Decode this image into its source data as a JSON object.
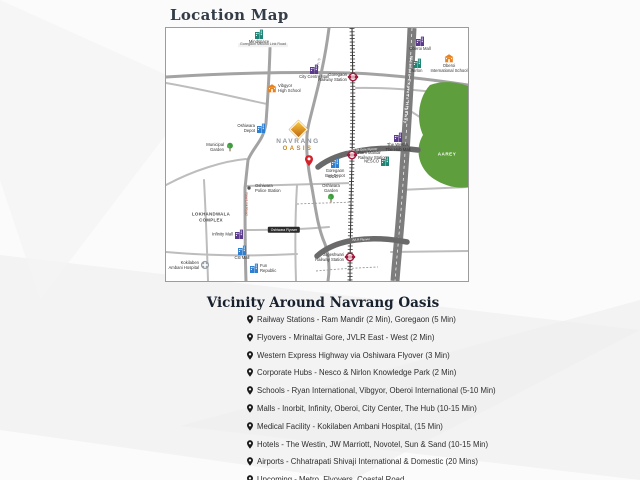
{
  "page": {
    "title": "Location Map"
  },
  "colors": {
    "accent_gold": "#c8861c",
    "station_red": "#9e1b3c",
    "aarey_green": "#5f9e3c",
    "highway_gray": "#7d7d7d"
  },
  "map": {
    "project": {
      "name_line1": "NAVRANG",
      "name_line2": "OASIS"
    },
    "road_labels": [
      {
        "id": "gmlr-road-label",
        "text": "Goregaon Mulund Link Road",
        "x": 97,
        "y": 17,
        "rot": 0,
        "size": 3.6,
        "color": "#555",
        "bg": "#f2f2f2"
      },
      {
        "id": "weh-road-label",
        "text": "Western Express Highway",
        "x": 242,
        "y": 62,
        "rot": 95,
        "size": 4,
        "color": "#ffffff",
        "bold": true,
        "ls": 0.8
      },
      {
        "id": "sv-road-label",
        "text": "S. V. Road",
        "x": 151,
        "y": 38,
        "rot": 100,
        "size": 3.4,
        "color": "#777"
      },
      {
        "id": "new-link-road-label",
        "text": "New Link Road",
        "x": 80,
        "y": 176,
        "rot": 90,
        "size": 3.4,
        "color": "#b5483a"
      },
      {
        "id": "mrinal-tai-gore-flyover-label",
        "text": "Mrinal Tai Gore Flyover",
        "x": 196,
        "y": 122,
        "rot": -3,
        "size": 3,
        "color": "#ffffff"
      },
      {
        "id": "jvlr-flyover-label",
        "text": "JVLR Flyover",
        "x": 195,
        "y": 212,
        "rot": -3,
        "size": 3,
        "color": "#ffffff"
      },
      {
        "id": "aarey-label",
        "text": "AAREY",
        "x": 281,
        "y": 127,
        "rot": 0,
        "size": 4.6,
        "color": "#ffffff",
        "bold": true,
        "ls": 0.5
      }
    ],
    "landmarks": [
      {
        "id": "mindspace",
        "type": "building",
        "color": "#1e8476",
        "x": 93,
        "y": 6,
        "side": "below",
        "label": "Mindspace"
      },
      {
        "id": "vibgyor-high-school",
        "type": "school",
        "color": "#e8821e",
        "x": 106,
        "y": 60,
        "side": "right",
        "label": "Vibgyor\nHigh School"
      },
      {
        "id": "city-centre-mall",
        "type": "building",
        "color": "#5b3a8e",
        "x": 148,
        "y": 41,
        "side": "below",
        "label": "City Centre Mall"
      },
      {
        "id": "goregaon-railway-station",
        "type": "station",
        "x": 187,
        "y": 49,
        "side": "left",
        "label": "Goregaon\nRailway Station"
      },
      {
        "id": "oberoi-mall",
        "type": "building",
        "color": "#5b3a8e",
        "x": 254,
        "y": 13,
        "side": "below",
        "label": "Oberoi Mall"
      },
      {
        "id": "nirlon",
        "type": "building",
        "color": "#1e8476",
        "x": 251,
        "y": 35,
        "side": "below",
        "label": "Nirlon"
      },
      {
        "id": "oberoi-international-school",
        "type": "school",
        "color": "#e8821e",
        "x": 283,
        "y": 30,
        "side": "below",
        "label": "Oberoi\nInternational School"
      },
      {
        "id": "the-westin-the-hub-mall",
        "type": "building",
        "color": "#5b3a8e",
        "x": 232,
        "y": 109,
        "side": "below",
        "label": "The Westin,\nThe Hub Mall"
      },
      {
        "id": "nesco",
        "type": "building",
        "color": "#1e8476",
        "x": 219,
        "y": 133,
        "side": "left",
        "label": "NESCO"
      },
      {
        "id": "ram-mandir-railway-station",
        "type": "station",
        "x": 186,
        "y": 127,
        "side": "right",
        "label": "Ram Mandir\nRailway Station"
      },
      {
        "id": "goregaon-bus-depot",
        "type": "building",
        "color": "#2f7fd0",
        "x": 169,
        "y": 135,
        "side": "below",
        "label": "Goregaon\nBus Depot"
      },
      {
        "id": "odc",
        "type": "text",
        "x": 167,
        "y": 149,
        "label": "ODC",
        "color": "#666",
        "size": 4.4,
        "bold": true
      },
      {
        "id": "oshiwara-garden",
        "type": "tree",
        "x": 165,
        "y": 170,
        "side": "above",
        "label": "Oshiwara\nGarden"
      },
      {
        "id": "municipal-garden",
        "type": "tree",
        "x": 64,
        "y": 119,
        "side": "left",
        "label": "Municipal\nGarden"
      },
      {
        "id": "oshiwara-depot",
        "type": "building",
        "color": "#2f7fd0",
        "x": 95,
        "y": 100,
        "side": "left",
        "label": "Oshiwara\nDepot"
      },
      {
        "id": "lokhandwala-complex",
        "type": "text",
        "x": 45,
        "y": 189,
        "label": "LOKHANDWALA\nCOMPLEX",
        "color": "#4a4a4a",
        "size": 4.4,
        "bold": true,
        "ls": 0.3
      },
      {
        "id": "oshiwara-police-station",
        "type": "dot",
        "x": 83,
        "y": 160,
        "side": "right",
        "label": "Oshiwara\nPolice Station"
      },
      {
        "id": "infinity-mall",
        "type": "building",
        "color": "#5b3a8e",
        "x": 73,
        "y": 206,
        "side": "left",
        "label": "Infinity Mall"
      },
      {
        "id": "citi-mall",
        "type": "building",
        "color": "#2f7fd0",
        "x": 76,
        "y": 222,
        "side": "below",
        "label": "Citi Mall"
      },
      {
        "id": "fun-republic",
        "type": "building",
        "color": "#2f7fd0",
        "x": 88,
        "y": 240,
        "side": "right",
        "label": "Fun\nRepublic"
      },
      {
        "id": "kokilaben-ambani-hospital",
        "type": "hospital",
        "x": 39,
        "y": 237,
        "side": "left",
        "label": "Kokilaben\nAmbani Hospital"
      },
      {
        "id": "oshiwara-flyover",
        "type": "blackbox",
        "x": 118,
        "y": 202,
        "label": "Oshiwara Flyover"
      },
      {
        "id": "jogeshwari-railway-station",
        "type": "station",
        "x": 184,
        "y": 229,
        "side": "left",
        "label": "Jogeshwari\nRailway Station"
      }
    ]
  },
  "vicinity": {
    "heading": "Vicinity Around Navrang Oasis",
    "items": [
      "Railway Stations - Ram Mandir (2 Min), Goregaon (5 Min)",
      "Flyovers - Mrinaltai Gore, JVLR East - West (2 Min)",
      "Western Express Highway via Oshiwara Flyover (3 Min)",
      "Corporate Hubs - Nesco & Nirlon Knowledge Park (2 Min)",
      "Schools - Ryan International, Vibgyor, Oberoi International (5-10 Min)",
      "Malls - Inorbit, Infinity, Oberoi, City Center, The Hub (10-15 Min)",
      "Medical Facility - Kokilaben Ambani Hospital, (15 Min)",
      "Hotels - The Westin, JW Marriott, Novotel, Sun & Sand (10-15 Min)",
      "Airports - Chhatrapati Shivaji International & Domestic (20 Mins)",
      "Upcoming - Metro, Flyovers, Coastal Road"
    ]
  }
}
